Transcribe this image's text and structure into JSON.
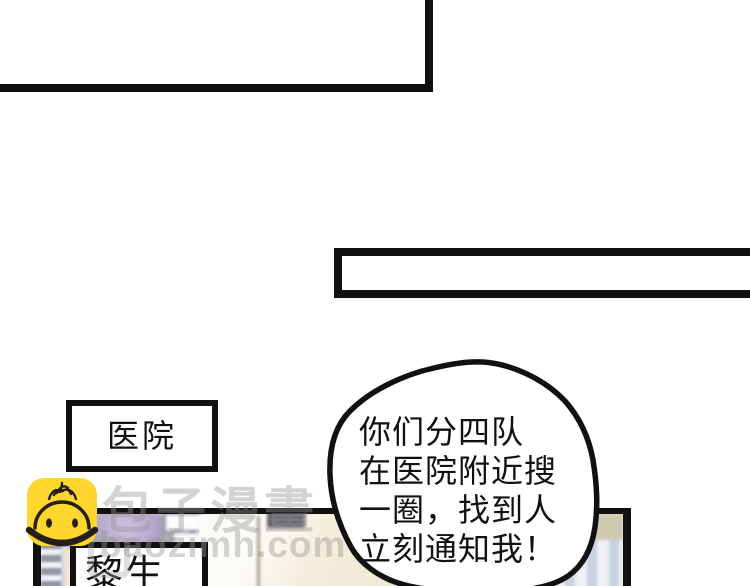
{
  "page": {
    "background": "#ffffff",
    "ink": "#111111"
  },
  "comic": {
    "hospital_sign": "医院",
    "name_tag": "黎生",
    "speech_bubble": {
      "lines": [
        "你们分四队",
        "在医院附近搜",
        "一圈，找到人",
        "立刻通知我！"
      ]
    }
  },
  "watermark": {
    "brand": "包子漫畫",
    "domain": "baozimh.com",
    "mascot_icon": "baozi-mascot-icon",
    "mascot_color": "#FFD62E"
  },
  "colors": {
    "panel_cream": "#efe7d4",
    "lavender": "#b4a8cc",
    "radiator_slate": "#9296a6",
    "strip_blue": "#c9d2df"
  }
}
